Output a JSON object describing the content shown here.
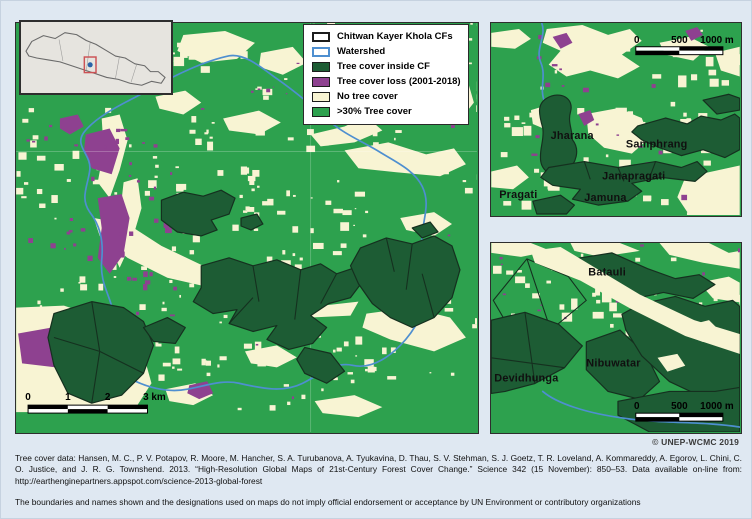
{
  "colors": {
    "page_bg": "#dfe8f2",
    "map_green": "#2da14e",
    "cf_dark": "#1d5c34",
    "cf_stroke": "#15301f",
    "purple": "#8e4190",
    "cream": "#f8f4d3",
    "watershed": "#4e8fd0",
    "loc_bg": "#e6e4df",
    "loc_red": "#cc5255",
    "loc_dot": "#2a62a8"
  },
  "legend": {
    "items": [
      {
        "label": "Chitwan Kayer Khola CFs"
      },
      {
        "label": "Watershed"
      },
      {
        "label": "Tree cover inside CF"
      },
      {
        "label": "Tree cover loss (2001-2018)"
      },
      {
        "label": "No tree cover"
      },
      {
        "label": ">30% Tree cover"
      }
    ]
  },
  "main_map": {
    "scale_labels": [
      "0",
      "1",
      "2",
      "3 km"
    ]
  },
  "inset_top": {
    "scale_labels": [
      "0",
      "500",
      "1000 m"
    ],
    "places": [
      "Jharana",
      "Samphrang",
      "Janapragati",
      "Pragati",
      "Jamuna"
    ]
  },
  "inset_bottom": {
    "scale_labels": [
      "0",
      "500",
      "1000 m"
    ],
    "places": [
      "Batauli",
      "Nibuwatar",
      "Devidhunga"
    ]
  },
  "footer": {
    "copyright": "© UNEP-WCMC 2019",
    "credit": "Tree cover data: Hansen, M. C., P. V. Potapov, R. Moore, M. Hancher, S. A. Turubanova, A. Tyukavina, D. Thau, S. V. Stehman, S. J. Goetz, T. R. Loveland, A. Kommareddy, A. Egorov, L. Chini, C. O. Justice, and J. R. G. Townshend. 2013. “High-Resolution Global Maps of 21st-Century Forest Cover Change.” Science 342 (15 November): 850–53. Data available on-line from: http://earthenginepartners.appspot.com/science-2013-global-forest",
    "disclaimer": "The boundaries and names shown and the designations used on maps do not imply official endorsement or acceptance by UN Environment or contributory organizations"
  }
}
